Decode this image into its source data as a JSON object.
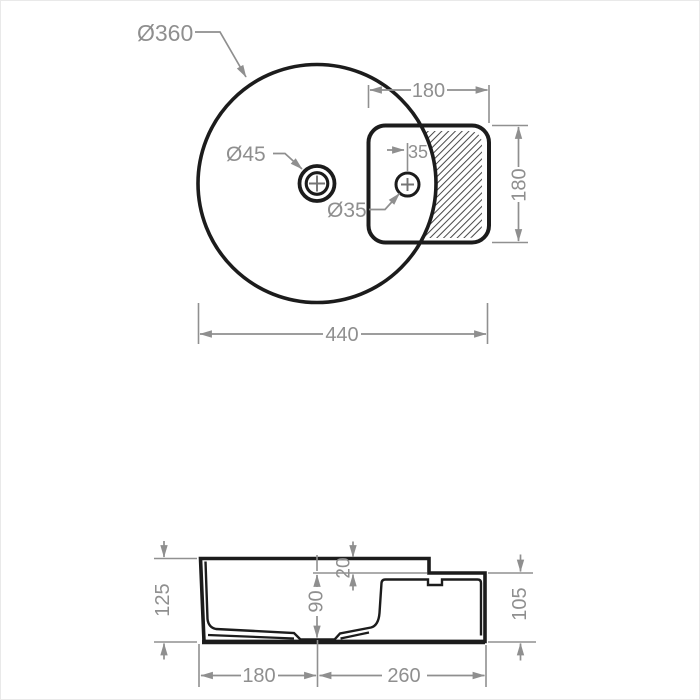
{
  "drawing": {
    "type": "washbasin-technical-drawing",
    "top_view": {
      "labels": {
        "basin_diameter": "Ø360",
        "drain_diameter": "Ø45",
        "tap_hole_diameter": "Ø35",
        "deck_width": "180",
        "deck_depth": "180",
        "tap_offset": "35",
        "overall_width": "440"
      }
    },
    "side_view": {
      "labels": {
        "height_left": "125",
        "rim_step": "20",
        "bowl_depth": "90",
        "height_right": "105",
        "bottom_left_width": "180",
        "bottom_right_width": "260"
      }
    },
    "colors": {
      "object_line": "#1c1c1c",
      "dimension_line": "#8f8f8f",
      "hatch_line": "#474747",
      "background": "#ffffff"
    }
  }
}
